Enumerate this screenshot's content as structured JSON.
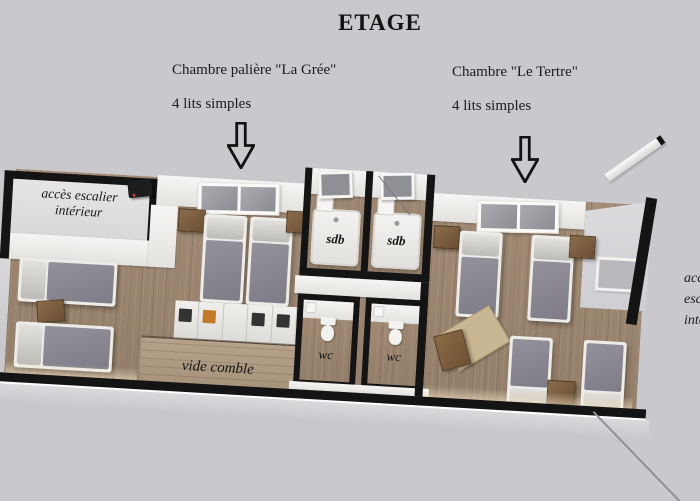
{
  "title": "ETAGE",
  "annotations": {
    "la_gree": {
      "name": "Chambre palière \"La Grée\"",
      "beds": "4 lits simples"
    },
    "le_tertre": {
      "name": "Chambre \"Le Tertre\"",
      "beds": "4 lits simples"
    }
  },
  "plan": {
    "stair_access": {
      "line1": "accès escalier",
      "line2": "intérieur"
    },
    "stair_access_right": {
      "line1": "accès",
      "line2": "escalier",
      "line3": "intérieur"
    },
    "sdb_left": "sdb",
    "sdb_right": "sdb",
    "wc_left": "wc",
    "wc_right": "wc",
    "vide_comble": "vide comble"
  },
  "colors": {
    "background": "#c9c8cd",
    "wall": "#141414",
    "wood_floor": "#9c8672",
    "wood_floor_light": "#b29d86",
    "white_surface": "#f2f1ef",
    "bed_blanket": "#8b8893",
    "bed_sheet": "#d8d6d2",
    "furniture_wood": "#7b5d3e",
    "rug": "#c9b692"
  }
}
